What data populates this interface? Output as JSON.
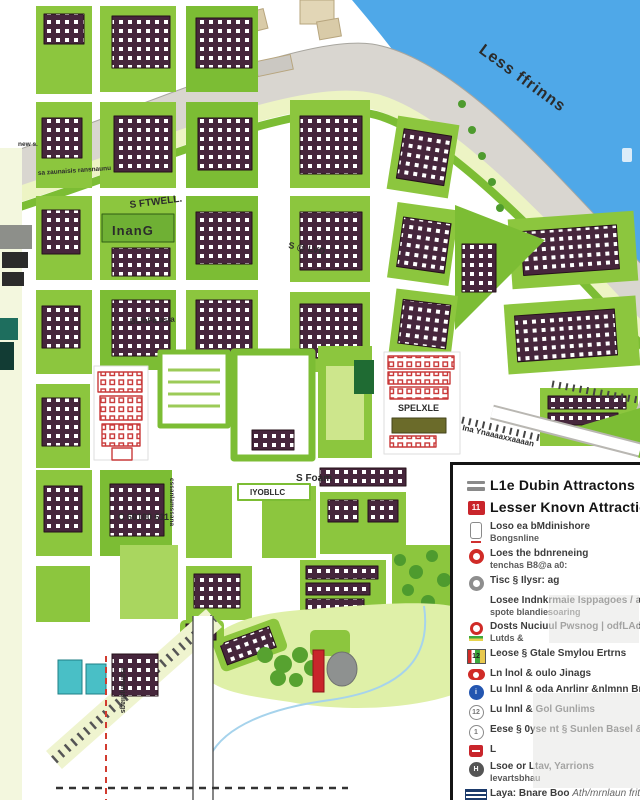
{
  "map": {
    "river_label": "Less ffrinns",
    "labels": [
      {
        "text": "Less ffrinns"
      },
      {
        "text": "S FTWELL."
      },
      {
        "text": "InanG"
      },
      {
        "text": "S @ LVD"
      },
      {
        "text": "BLIbFa asia"
      },
      {
        "text": "C 60100 611"
      },
      {
        "text": "S Foam"
      },
      {
        "text": "IYOBLLC"
      },
      {
        "text": "Ina Ynaaaaxxaaaan"
      },
      {
        "text": "Istlrnmjsliags"
      },
      {
        "text": "cssanlamssana"
      },
      {
        "text": "new s."
      },
      {
        "text": "sa zaunaisis ransnaunu"
      },
      {
        "text": "SPELXLE"
      }
    ],
    "colors": {
      "water": "#4FA8E8",
      "park_green": "#8CC63E",
      "building_purple": "#46263C",
      "quay_gray": "#D9D6D0",
      "attraction_red": "#C9252B",
      "teal_building": "#49BFC6"
    }
  },
  "legend": {
    "items": [
      {
        "icon": "double-bar",
        "label": "L1e Dubin Attractons"
      },
      {
        "icon": "red-badge",
        "badge": "11",
        "label": "Lesser Knovn Attractions"
      },
      {
        "icon": "phone-red-dash",
        "label": "Loso ea bMdinishore",
        "sub": "Bongsnline"
      },
      {
        "icon": "red-circle",
        "label": "Loes the bdnreneing",
        "sub": "tenchas B8@a a0:"
      },
      {
        "icon": "gray-circle",
        "label": "Tisc § Ilysr: ag"
      },
      {
        "icon": "none",
        "label": "Losee Indnkrmaie Isppagoes / ars ost",
        "sub": "spote blandiesoaring"
      },
      {
        "icon": "red-circle-green-bar",
        "label": "Dosts Nuciuul Pwsnog | odfLAdte mg",
        "sub": "Lutds &"
      },
      {
        "icon": "color-square",
        "badge": "12",
        "label": "Leose § Gtale Smylou Ertrns"
      },
      {
        "icon": "red-oval",
        "label": "Ln lnol & oulo Jinags"
      },
      {
        "icon": "blue-circle",
        "badge": "i",
        "label": "Lu lnnl & oda Anrlinr &nlmnn Bnl"
      },
      {
        "icon": "outline-circle",
        "badge": "12",
        "label": "Lu lnnl & Gol Gunlims"
      },
      {
        "icon": "outline-circle",
        "badge": "1",
        "label": "Eese § 0yse nt § Sunlen Basel &nt"
      },
      {
        "icon": "red-bag",
        "label": "L"
      },
      {
        "icon": "dark-circle",
        "badge": "H",
        "label": "Lsoe or Ltav, Yarrions",
        "sub": "Ievartsbhau"
      },
      {
        "icon": "navy-stripes",
        "label": "Laya: Bnare Boo",
        "label_italic": "Ath/mrnlaun frit"
      },
      {
        "icon": "phone-outline",
        "label": "Tr bnrl S1ess"
      },
      {
        "icon": "red-square",
        "label": "Lu lne! S2vg;"
      }
    ]
  }
}
